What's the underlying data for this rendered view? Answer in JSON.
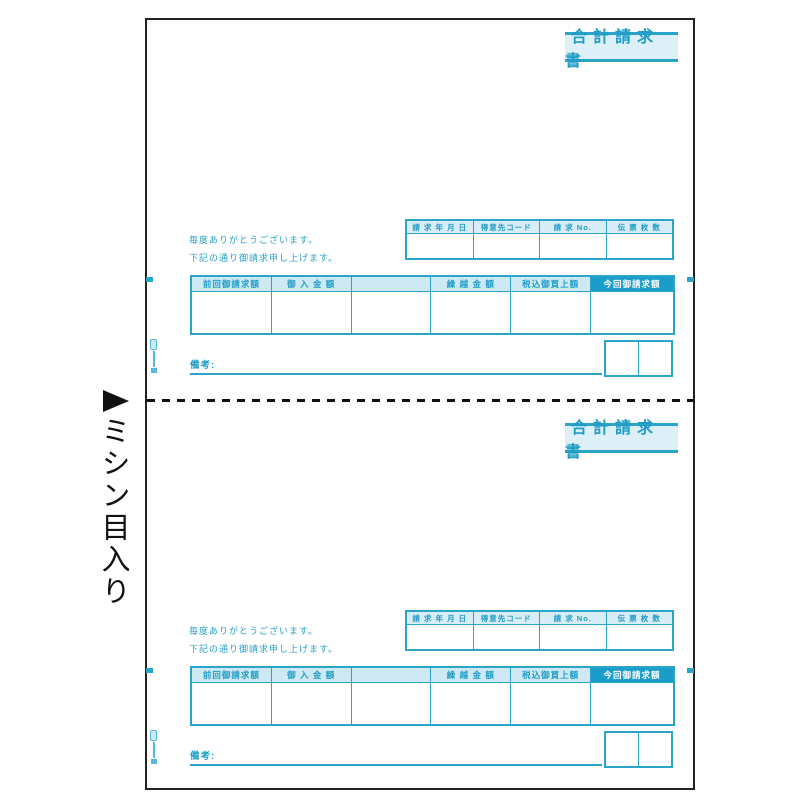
{
  "colors": {
    "teal": "#2aa4c9",
    "teal_text": "#1e9cc6",
    "teal_fill_light": "#d8edf7",
    "teal_fill_solid": "#1b9dc9",
    "paper_border": "#222222"
  },
  "page": {
    "perforation_label": "ミシン目入り",
    "perforation_arrow_icon": "right-triangle-icon"
  },
  "form": {
    "title": "合計請求書",
    "greeting_line1": "毎度ありがとうございます。",
    "greeting_line2": "下記の通り御請求申し上げます。",
    "info_table": {
      "headers": [
        "請 求 年 月 日",
        "得意先コード",
        "請 求 No.",
        "伝 票 枚 数"
      ],
      "values": [
        "",
        "",
        "",
        ""
      ]
    },
    "summary_table": {
      "headers": [
        "前回御請求額",
        "御 入 金 額",
        "",
        "繰 越 金 額",
        "税込御買上額",
        "今回御請求額"
      ],
      "values": [
        "",
        "",
        "",
        "",
        "",
        ""
      ]
    },
    "remarks_label": "備考:",
    "stamp_boxes": [
      "",
      ""
    ]
  }
}
